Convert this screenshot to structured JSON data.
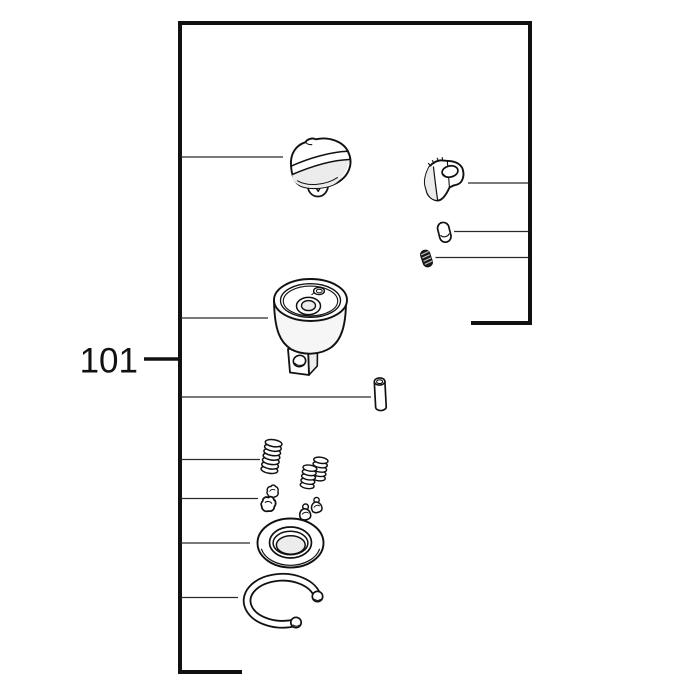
{
  "figure": {
    "callout_label": "101"
  },
  "colors": {
    "background": "#ffffff",
    "outline": "#111111",
    "leader": "#2a2a2a",
    "shade_light": "#ececec",
    "dark_part": "#1b1b1b"
  },
  "frame": {
    "path": "M473,323 L530,323 L530,23 L180,23 L180,672 L240,672"
  },
  "callout_tick": {
    "x1": 144,
    "y1": 359,
    "x2": 179,
    "y2": 359
  },
  "leader_lines": [
    {
      "part": "cap",
      "x1": 181,
      "y1": 157,
      "x2": 283,
      "y2": 157
    },
    {
      "part": "anvil",
      "x1": 181,
      "y1": 318,
      "x2": 268,
      "y2": 318
    },
    {
      "part": "pin",
      "x1": 181,
      "y1": 397,
      "x2": 371,
      "y2": 397
    },
    {
      "part": "pawl-spring",
      "x1": 181,
      "y1": 459.5,
      "x2": 260,
      "y2": 459.5
    },
    {
      "part": "pawl",
      "x1": 181,
      "y1": 498.5,
      "x2": 258,
      "y2": 498.5
    },
    {
      "part": "washer",
      "x1": 181,
      "y1": 543,
      "x2": 250,
      "y2": 543
    },
    {
      "part": "retaining-ring",
      "x1": 181,
      "y1": 597.5,
      "x2": 238,
      "y2": 597.5
    },
    {
      "part": "reverse-lever",
      "x1": 468,
      "y1": 183,
      "x2": 528.5,
      "y2": 183
    },
    {
      "part": "detent-pin",
      "x1": 454,
      "y1": 231.5,
      "x2": 528.5,
      "y2": 231.5
    },
    {
      "part": "detent-spring",
      "x1": 435.5,
      "y1": 257.5,
      "x2": 528.5,
      "y2": 257.5
    }
  ],
  "parts": [
    {
      "name": "cap-icon"
    },
    {
      "name": "reverse-lever-icon"
    },
    {
      "name": "detent-pin-icon"
    },
    {
      "name": "detent-spring-icon"
    },
    {
      "name": "anvil-icon"
    },
    {
      "name": "pin-icon"
    },
    {
      "name": "pawl-spring-icon"
    },
    {
      "name": "pawl-spring-pair-icon"
    },
    {
      "name": "pawl-icon"
    },
    {
      "name": "pawl-pair-icon"
    },
    {
      "name": "washer-icon"
    },
    {
      "name": "retaining-ring-icon"
    }
  ]
}
